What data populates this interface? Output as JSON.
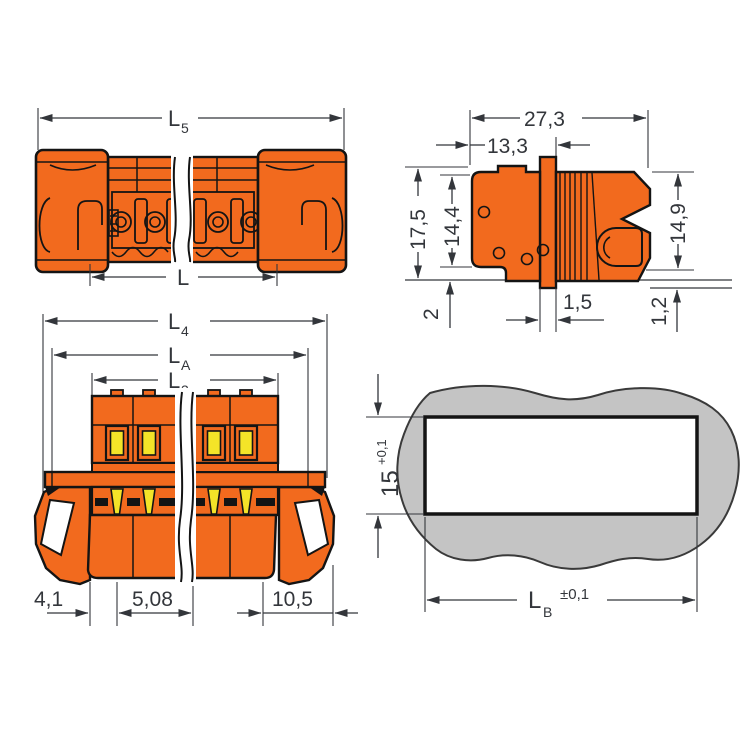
{
  "drawing": {
    "title": "connector-dimension-drawing",
    "colors": {
      "housing": "#F26A1E",
      "contact": "#F4E428",
      "panel": "#C4C4C4",
      "line": "#33363B",
      "background": "#FFFFFF"
    },
    "views": {
      "side": {
        "name": "side-view",
        "dims": {
          "L5_main": "L",
          "L5_sub": "5",
          "L_main": "L"
        }
      },
      "end": {
        "name": "end-view",
        "dims": {
          "total_width": "27,3",
          "front_depth": "13,3",
          "total_height": "17,5",
          "body_height": "14,4",
          "right_height": "14,9",
          "below_panel": "2",
          "flange_thickness": "1,5",
          "gap": "1,2"
        }
      },
      "front": {
        "name": "front-view",
        "dims": {
          "L4_main": "L",
          "L4_sub": "4",
          "LA_main": "L",
          "LA_sub": "A",
          "L3_main": "L",
          "L3_sub": "3",
          "left_offset": "4,1",
          "pitch": "5,08",
          "right_offset": "10,5"
        }
      },
      "cutout": {
        "name": "panel-cutout-view",
        "dims": {
          "height": "15",
          "height_tol": "+0,1",
          "width_main": "L",
          "width_sub": "B",
          "width_tol": "±0,1"
        }
      }
    }
  }
}
